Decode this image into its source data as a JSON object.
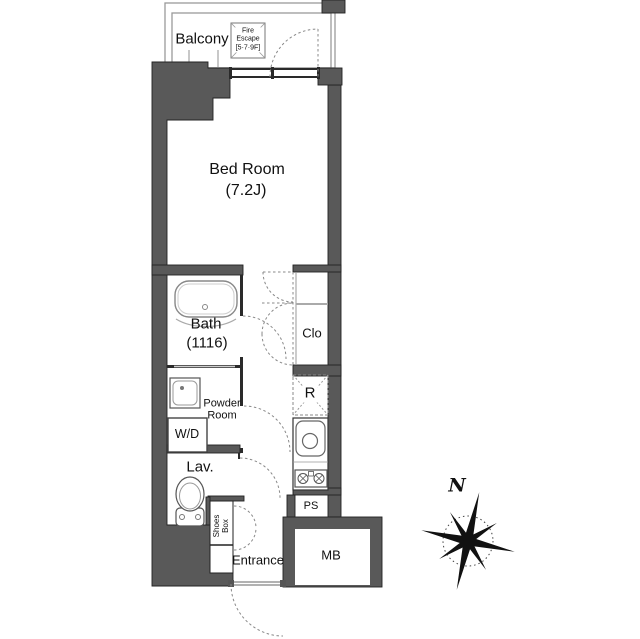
{
  "plan": {
    "balcony": "Balcony",
    "fire_escape": [
      "Fire",
      "Escape",
      "[5·7·9F]"
    ],
    "bedroom": {
      "name": "Bed Room",
      "size": "(7.2J)"
    },
    "bath": {
      "name": "Bath",
      "size": "(1116)"
    },
    "closet": "Clo",
    "refrigerator": "R",
    "powder_room": [
      "Powder",
      "Room"
    ],
    "washer_dryer": "W/D",
    "lavatory": "Lav.",
    "shoes_box": [
      "Shoes",
      "Box"
    ],
    "entrance": "Entrance",
    "pipe_space": "PS",
    "meter_box": "MB",
    "compass_north": "N"
  },
  "colors": {
    "wall_fill": "#595959",
    "wall_outline": "#222222",
    "thin_line": "#999999",
    "dashed_line": "#888888",
    "text": "#111111"
  }
}
